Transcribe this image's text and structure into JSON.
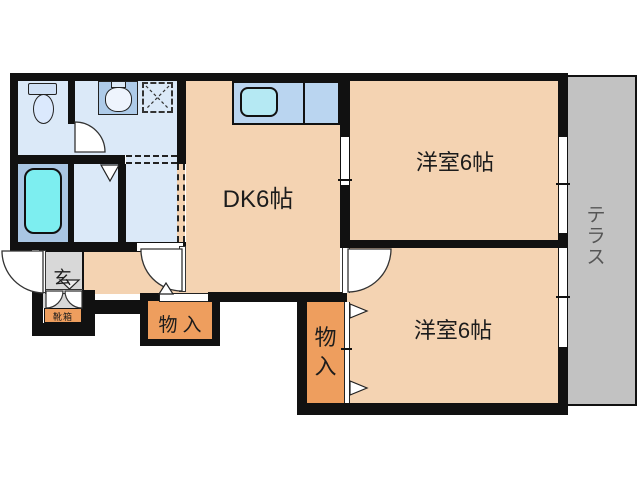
{
  "plan": {
    "title": "floor-plan",
    "rooms": {
      "dk": {
        "label": "DK6帖"
      },
      "bedroom_top": {
        "label": "洋室6帖"
      },
      "bedroom_bottom": {
        "label": "洋室6帖"
      },
      "terrace": {
        "label": "テラス"
      },
      "entrance": {
        "label": "玄"
      }
    },
    "storage": {
      "left": {
        "label": "物入"
      },
      "right": {
        "label": "物入"
      },
      "shoe_cabinet": {
        "label": "靴箱"
      }
    },
    "fixtures": [
      "toilet",
      "washbasin",
      "washing-machine-pan",
      "bathtub",
      "kitchen-sink"
    ],
    "colors": {
      "wall": "#111111",
      "room_floor": "#f4d3b2",
      "storage_fill": "#ee9e5e",
      "water_area_floor": "#dbe9f8",
      "bath_floor": "#a9c6e3",
      "bathtub": "#7deef0",
      "kitchen_counter": "#bad5f0",
      "kitchen_sink": "#b5e9f3",
      "basin_counter": "#aecbe9",
      "terrace": "#c2c2c2",
      "entrance_floor": "#d8d8d8",
      "terrace_text": "#555555"
    }
  }
}
